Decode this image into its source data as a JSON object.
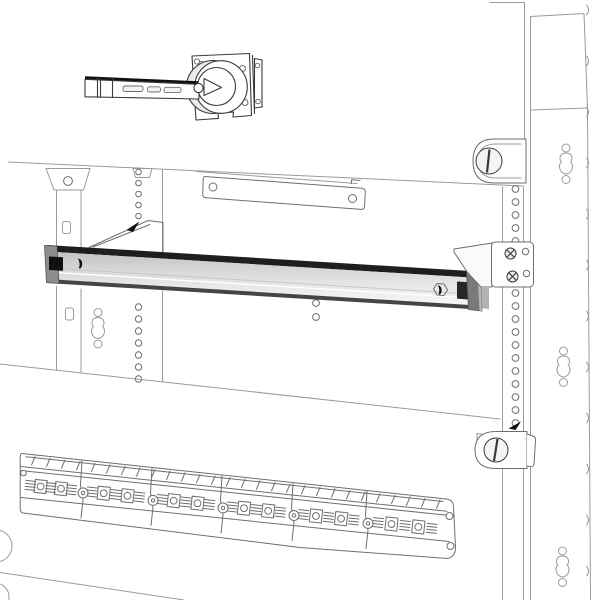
{
  "scene": {
    "description": "Monochrome technical line illustration of an electrical enclosure interior: rotary handle switch at top, gray DIN rail kit with side fixing brackets across the middle, perforated mounting uprights, quarter-turn locks on the right upright and a modular terminal block strip at the bottom",
    "background": "#ffffff",
    "text_content": "none"
  },
  "colors": {
    "line_light": "#9a9a9a",
    "line_mid": "#6e6e6e",
    "line_dark": "#3a3a3a",
    "rail_top": "#1e1e1e",
    "rail_face_hi": "#c2c2c2",
    "rail_face_lo": "#f7f7f7",
    "rail_bottom": "#454545",
    "rail_cap": "#8d8d8d",
    "rail_cap_side": "#b8b8b8",
    "black": "#111111",
    "white": "#ffffff",
    "shade": "#ebebeb",
    "gray_piece": "#b3b3b3"
  },
  "components": [
    {
      "name": "enclosure-back-panel"
    },
    {
      "name": "right-side-upright-panel"
    },
    {
      "name": "rotary-switch-with-handle-lever"
    },
    {
      "name": "horizontal-support-plate"
    },
    {
      "name": "din-rail"
    },
    {
      "name": "din-rail-left-bracket"
    },
    {
      "name": "din-rail-right-bracket"
    },
    {
      "name": "perforated-mounting-uprights"
    },
    {
      "name": "quarter-turn-lock-upper"
    },
    {
      "name": "quarter-turn-lock-lower"
    },
    {
      "name": "terminal-block-strip"
    }
  ],
  "terminal_strip": {
    "segments": 6
  },
  "fasteners": {
    "bracket_screws": 2
  }
}
